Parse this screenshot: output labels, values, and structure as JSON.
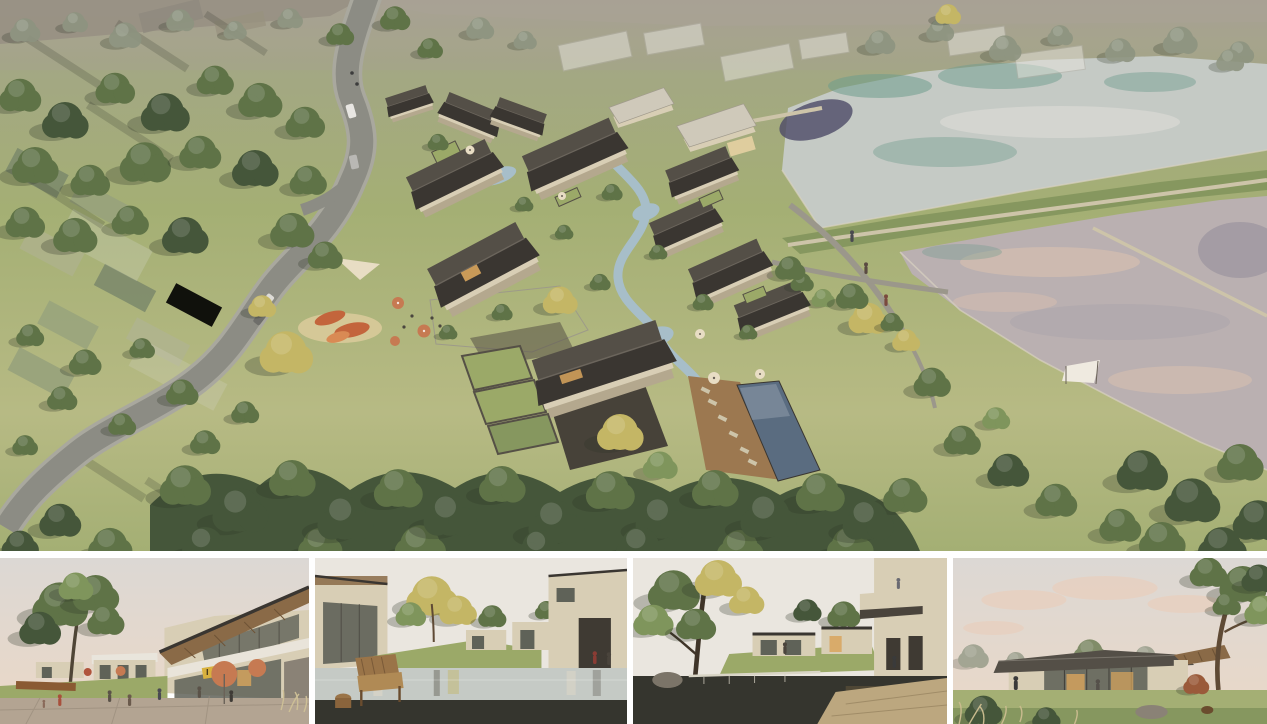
{
  "scene": {
    "main_view": "aerial-masterplan-render",
    "thumbnails": [
      "plaza-cafe-street-view",
      "reflecting-pool-courtyard-view",
      "pond-courtyard-view",
      "glass-pavilion-lawn-view"
    ]
  },
  "colors": {
    "gap_white": "#ffffff",
    "haze_top": "#a8a195",
    "haze_field": "#8f887d",
    "grass_olive": "#a3a784",
    "grass_light": "#b7ba84",
    "grass_mid": "#a4af74",
    "grass_dark": "#86975f",
    "lawn_green": "#9ba968",
    "tree_green": "#5f7347",
    "tree_dark": "#45563a",
    "tree_light": "#7f955c",
    "tree_yellow": "#c4b665",
    "tree_haze": "#8d9480",
    "road_grey": "#8c8c84",
    "road_light": "#a9a89e",
    "path_beige": "#cdc4a9",
    "path_grey": "#9b978b",
    "water_silver": "#c5cac5",
    "water_teal": "#6e9c8d",
    "water_navy": "#4c4a66",
    "water_pink": "#bab0b1",
    "water_pink_hi": "#dcc2af",
    "stream_blue": "#a7bec9",
    "pool_slate": "#5a6c80",
    "roof_dark": "#3a3631",
    "roof_mid": "#544f47",
    "roof_light": "#cfc9ba",
    "wall_cream": "#d8ceb5",
    "wall_shadow": "#b4a88e",
    "deck_brown": "#9c7850",
    "stone_dark": "#555046",
    "courtyard_dark": "#474239",
    "ghost_grey": "#e7e5de",
    "sand": "#dfcd9e",
    "accent_orange": "#c3653c",
    "umbrella_terracotta": "#c67a52",
    "canopy_cream": "#e8ddc4",
    "glass_dark": "#5f6258",
    "wood_warm": "#8a6a47",
    "sign_yellow": "#d8b13f",
    "window_glow": "#d9a55d",
    "paving_warm": "#b3a492",
    "sky_grey": "#dcd8d4",
    "sky_warm": "#e8d8c9",
    "sky_pale": "#eae6df",
    "cloud_pink": "#e9cfbd",
    "water_dark_fg": "#35352e"
  }
}
